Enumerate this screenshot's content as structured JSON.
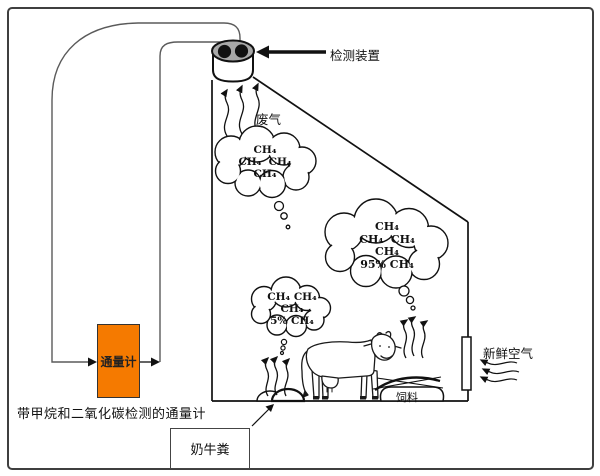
{
  "diagram": {
    "labels": {
      "detector": "检测装置",
      "waste_gas": "废气",
      "flux_meter": "通量计",
      "caption": "带甲烷和二氧化碳检测的通量计",
      "manure": "奶牛粪",
      "feed": "饲料",
      "fresh_air": "新鲜空气"
    },
    "clouds": {
      "top": {
        "lines": [
          "CH₄",
          "CH₄  CH₄",
          "CH₄"
        ]
      },
      "middle": {
        "lines": [
          "CH₄",
          "CH₄  CH₄",
          "CH₄",
          "95% CH₄"
        ]
      },
      "bottom": {
        "lines": [
          "CH₄ CH₄",
          "CH₄",
          "5% CH₄"
        ]
      }
    },
    "colors": {
      "flux_meter_fill": "#F57A00",
      "detector_top": "#A8A8A8",
      "line": "#111111"
    }
  }
}
